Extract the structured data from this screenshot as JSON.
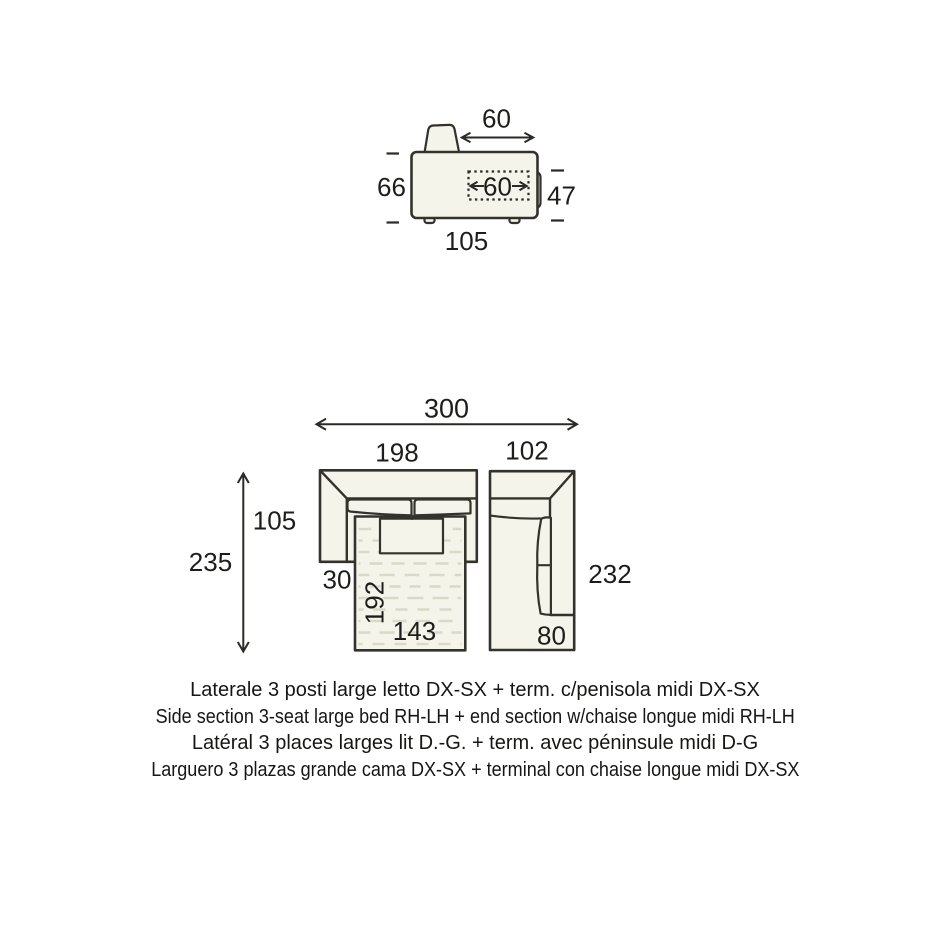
{
  "colors": {
    "background": "#ffffff",
    "upholstery_fill": "#f4f4ea",
    "outline": "#34322c",
    "dimension_text": "#1d1d1b",
    "mattress_texture": "#d9d9c9"
  },
  "side_view": {
    "top_width": "60",
    "height": "66",
    "seat_depth": "60",
    "armrest_height": "47",
    "total_depth": "105"
  },
  "top_view": {
    "total_width": "300",
    "side_section_width": "198",
    "end_section_width": "102",
    "open_bed_total_depth": "235",
    "section_depth": "105",
    "arm_width": "30",
    "bed_length": "192",
    "bed_width": "143",
    "end_section_depth": "232",
    "chaise_width": "80"
  },
  "captions": {
    "italian": "Laterale 3 posti large letto DX-SX + term. c/penisola midi DX-SX",
    "english": "Side section 3-seat large bed RH-LH + end section w/chaise longue midi RH-LH",
    "french": "Latéral 3 places larges lit D.-G. + term. avec péninsule midi D-G",
    "spanish": "Larguero 3 plazas grande cama DX-SX + terminal con chaise longue midi DX-SX"
  }
}
